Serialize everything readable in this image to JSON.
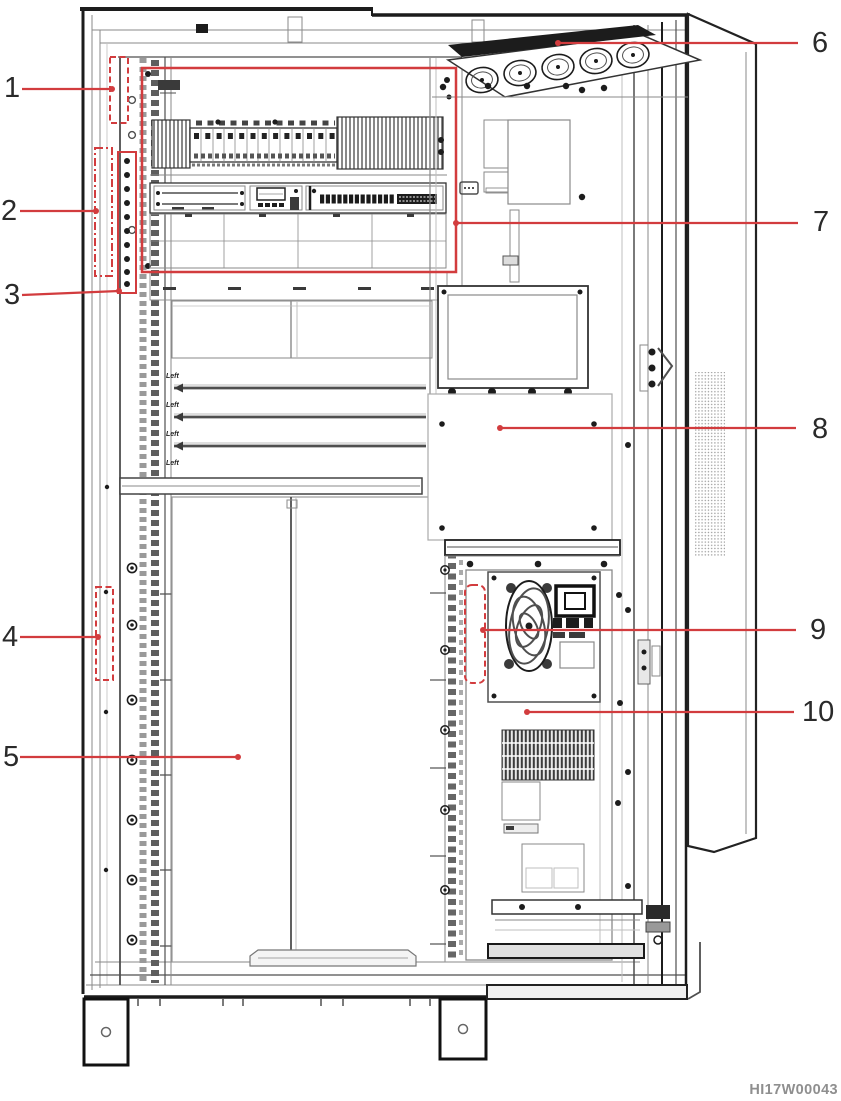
{
  "figure": {
    "code": "HI17W00043"
  },
  "colors": {
    "annotation_red": "#d23c3e",
    "drawing_dark": "#1c1c1c",
    "drawing_gray": "#8a8a8a",
    "figure_code_gray": "#8f8f8f",
    "background": "#ffffff"
  },
  "callouts": [
    {
      "number": "1",
      "marker": "dashed-box"
    },
    {
      "number": "2",
      "marker": "dash-dot-box"
    },
    {
      "number": "3",
      "marker": "solid-box"
    },
    {
      "number": "4",
      "marker": "dashed-box"
    },
    {
      "number": "5",
      "marker": "leader-line"
    },
    {
      "number": "6",
      "marker": "leader-line"
    },
    {
      "number": "7",
      "marker": "solid-box"
    },
    {
      "number": "8",
      "marker": "leader-line"
    },
    {
      "number": "9",
      "marker": "dashed-box"
    },
    {
      "number": "10",
      "marker": "leader-line"
    }
  ],
  "shelf_labels": [
    "Left",
    "Left",
    "Left",
    "Left"
  ],
  "icons": {
    "fan-tray-icon": "row of 5 impellers",
    "fan-icon": "swirl impeller circle",
    "heatsink-icon": "vertical fin hatch block",
    "mesh-vent-icon": "dotted grille strip"
  }
}
